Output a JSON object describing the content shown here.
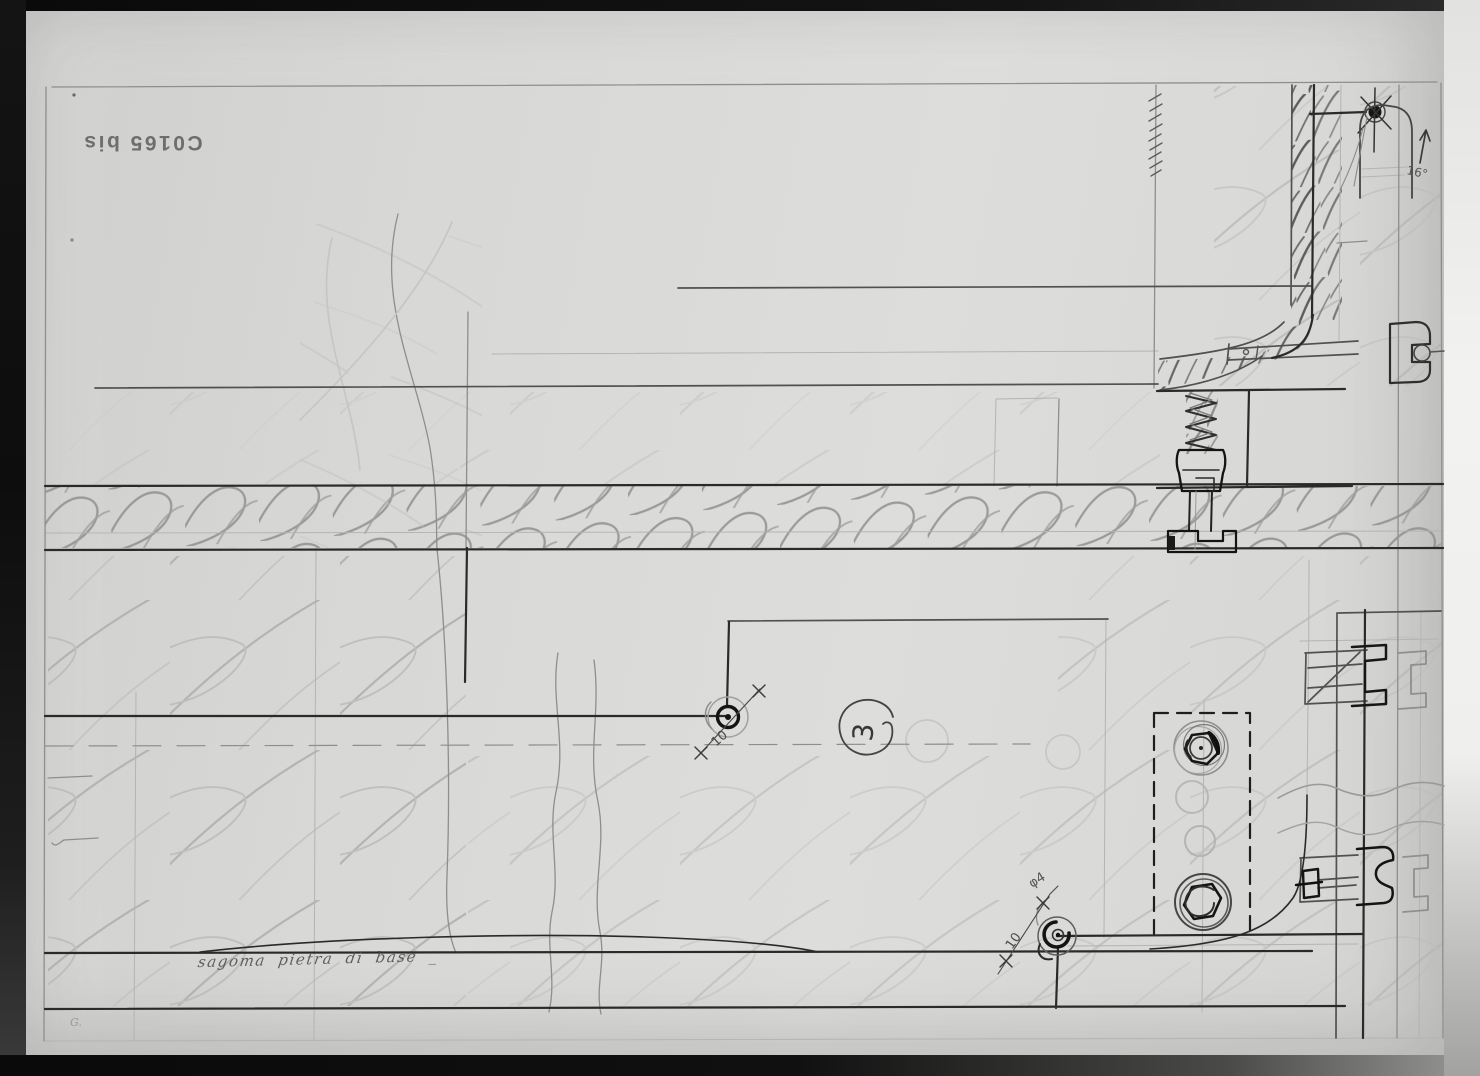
{
  "palette": {
    "paper": "#d8d8d6",
    "frame_dark": "#0e0e0e",
    "edge_light": "#f0f0ee",
    "pencil_faint": "#b6b6b4",
    "pencil_light": "#8e8e8c",
    "pencil_mid": "#555553",
    "pencil_dark": "#2a2a28",
    "pencil_black": "#161614"
  },
  "stamp": {
    "text": "C0165 bis"
  },
  "labels": {
    "handwriting": "sagoma pietra di base _",
    "callout": "3",
    "pivot_dim_left": "10",
    "pivot_dim_bottom": "10",
    "pivot_dia_bottom": "φ4",
    "angle": "16°",
    "corner_mark": "G."
  }
}
